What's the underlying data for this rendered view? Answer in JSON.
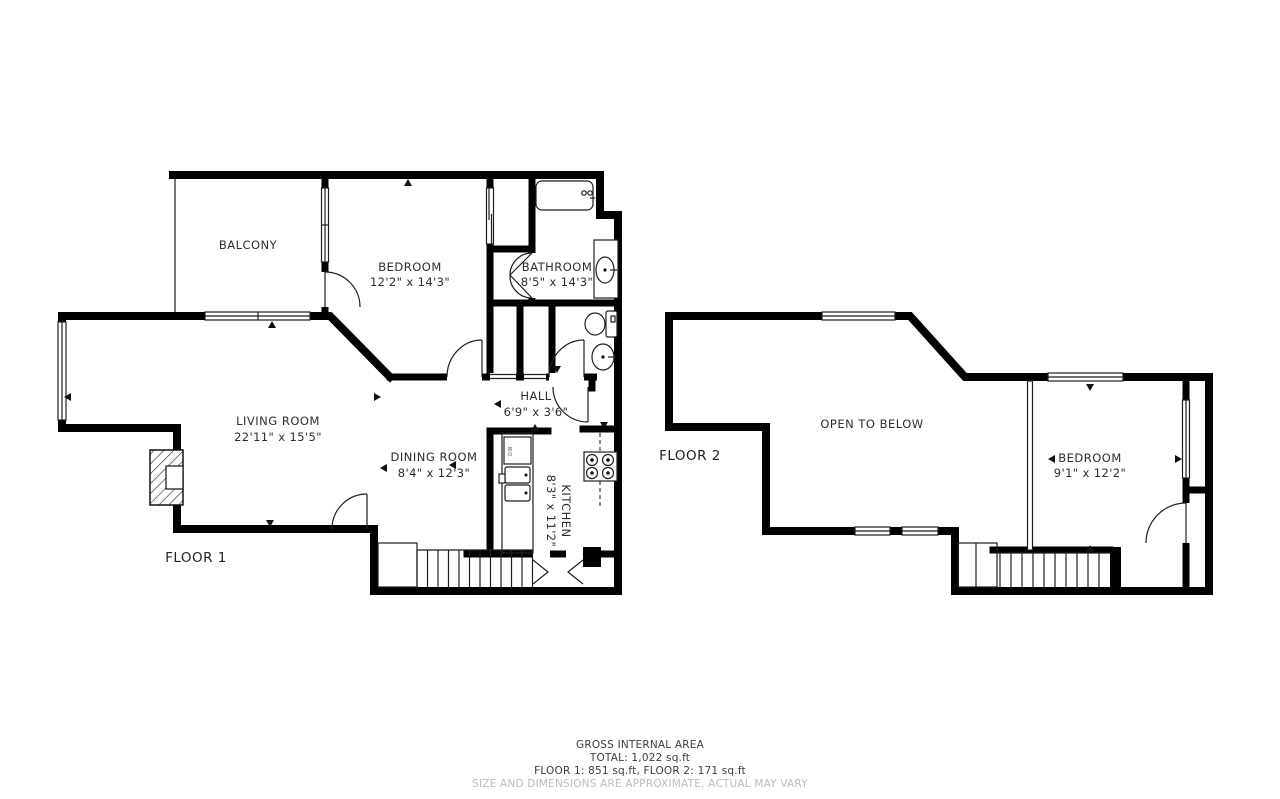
{
  "floor1": {
    "label": "FLOOR 1",
    "balcony": {
      "name": "BALCONY"
    },
    "bedroom": {
      "name": "BEDROOM",
      "dims": "12'2\" x 14'3\""
    },
    "bathroom": {
      "name": "BATHROOM",
      "dims": "8'5\" x 14'3\""
    },
    "hall": {
      "name": "HALL",
      "dims": "6'9\" x 3'6\""
    },
    "living_room": {
      "name": "LIVING ROOM",
      "dims": "22'11\" x 15'5\""
    },
    "dining_room": {
      "name": "DINING ROOM",
      "dims": "8'4\" x 12'3\""
    },
    "kitchen": {
      "name": "KITCHEN",
      "dims": "8'3\" x 11'2\""
    },
    "dishwasher": "DW"
  },
  "floor2": {
    "label": "FLOOR 2",
    "open_to_below": {
      "name": "OPEN TO BELOW"
    },
    "bedroom": {
      "name": "BEDROOM",
      "dims": "9'1\" x 12'2\""
    }
  },
  "footer": {
    "title": "GROSS INTERNAL AREA",
    "total": "TOTAL: 1,022 sq.ft",
    "floors": "FLOOR 1: 851 sq.ft, FLOOR 2: 171 sq.ft",
    "disclaimer": "SIZE AND DIMENSIONS ARE APPROXIMATE, ACTUAL MAY VARY"
  },
  "colors": {
    "wall": "#000000",
    "line": "#1f1f1f",
    "muted": "#bdbdbd"
  }
}
